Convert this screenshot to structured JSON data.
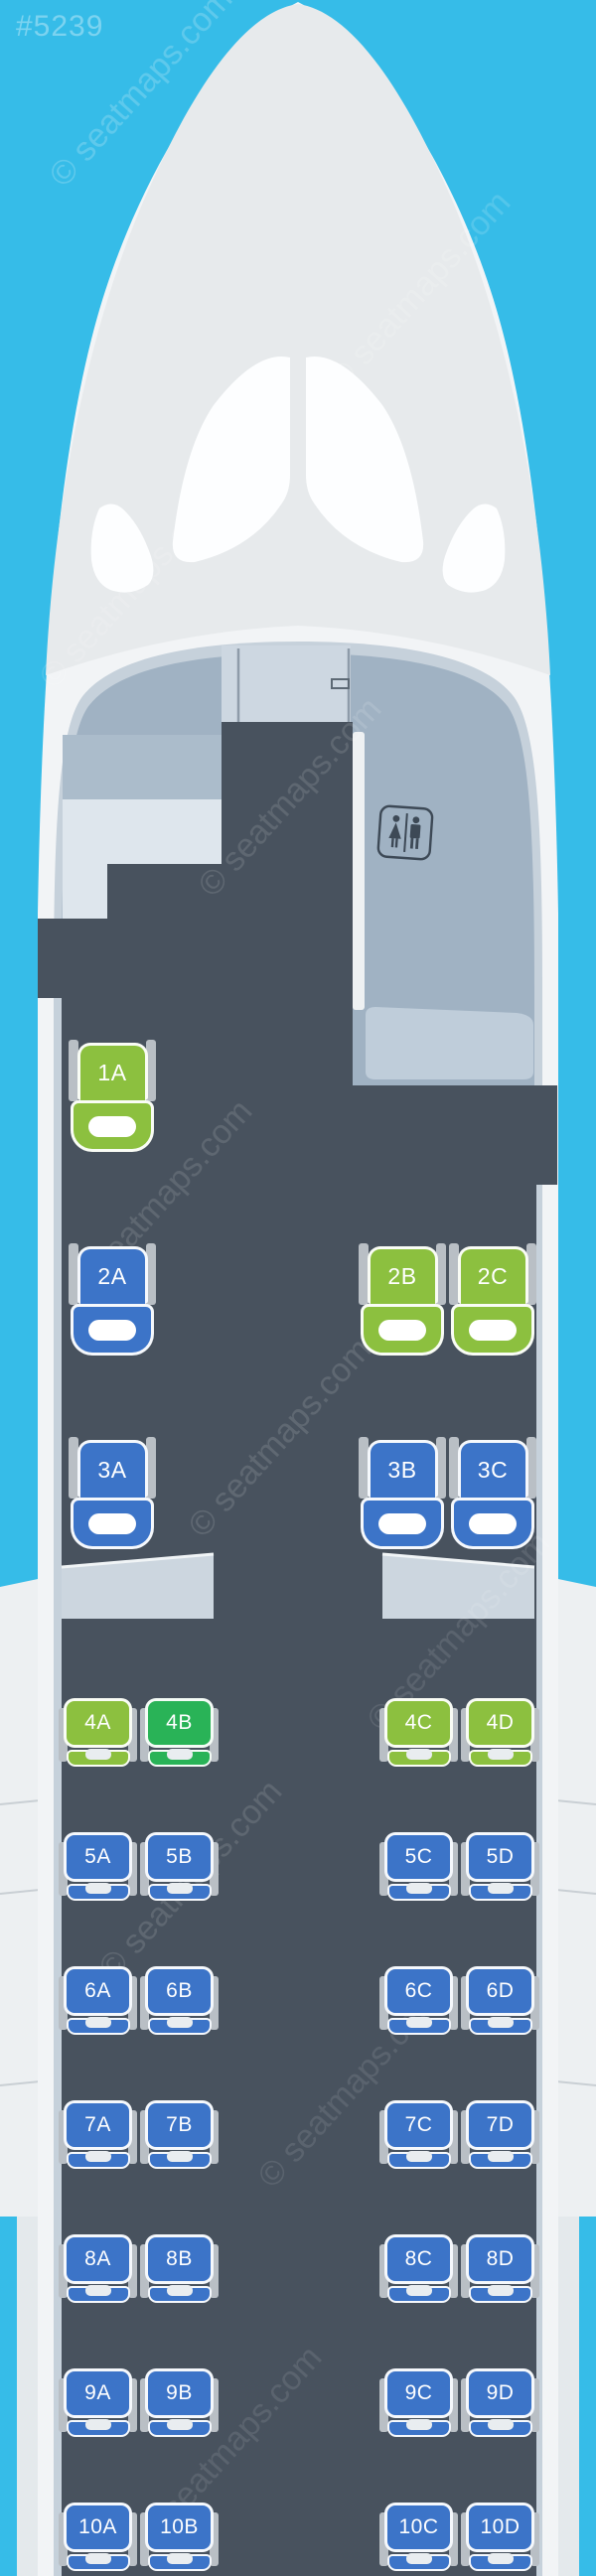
{
  "page": {
    "id_tag": "#5239",
    "watermark_text": "© seatmaps.com"
  },
  "colors": {
    "background_blue": "#36bce8",
    "fuselage_white": "#f2f4f6",
    "nose_gray": "#e7eaec",
    "windshield_white": "#fdfeff",
    "cabin_dark": "#48525e",
    "interior_bluegray": "#a0b2c3",
    "arch_rim": "#c6d1db",
    "cockpit_door": "#cdd7e1",
    "galley_top": "#abbccb",
    "galley_bottom": "#dee6ed",
    "closet_monument": "#bfcdda",
    "bulkhead_slab": "#ccd6df",
    "wing_gray": "#edf0f2",
    "nacelle_gray": "#e4e9ec",
    "seat_blue": "#3c74c8",
    "seat_green": "#8cc03f",
    "seat_emerald": "#29b357",
    "armrest_gray": "#b9bfc5",
    "lavatory_icon": "#3d4956"
  },
  "icons": {
    "lavatory": "lavatory-sign"
  },
  "seat_rows": [
    {
      "row": "1",
      "seats": [
        {
          "id": "1A",
          "color": "green"
        }
      ]
    },
    {
      "row": "2",
      "seats": [
        {
          "id": "2A",
          "color": "blue"
        },
        {
          "id": "2B",
          "color": "green"
        },
        {
          "id": "2C",
          "color": "green"
        }
      ]
    },
    {
      "row": "3",
      "seats": [
        {
          "id": "3A",
          "color": "blue"
        },
        {
          "id": "3B",
          "color": "blue"
        },
        {
          "id": "3C",
          "color": "blue"
        }
      ]
    },
    {
      "row": "4",
      "seats": [
        {
          "id": "4A",
          "color": "green"
        },
        {
          "id": "4B",
          "color": "emerald"
        },
        {
          "id": "4C",
          "color": "green"
        },
        {
          "id": "4D",
          "color": "green"
        }
      ]
    },
    {
      "row": "5",
      "seats": [
        {
          "id": "5A",
          "color": "blue"
        },
        {
          "id": "5B",
          "color": "blue"
        },
        {
          "id": "5C",
          "color": "blue"
        },
        {
          "id": "5D",
          "color": "blue"
        }
      ]
    },
    {
      "row": "6",
      "seats": [
        {
          "id": "6A",
          "color": "blue"
        },
        {
          "id": "6B",
          "color": "blue"
        },
        {
          "id": "6C",
          "color": "blue"
        },
        {
          "id": "6D",
          "color": "blue"
        }
      ]
    },
    {
      "row": "7",
      "seats": [
        {
          "id": "7A",
          "color": "blue"
        },
        {
          "id": "7B",
          "color": "blue"
        },
        {
          "id": "7C",
          "color": "blue"
        },
        {
          "id": "7D",
          "color": "blue"
        }
      ]
    },
    {
      "row": "8",
      "seats": [
        {
          "id": "8A",
          "color": "blue"
        },
        {
          "id": "8B",
          "color": "blue"
        },
        {
          "id": "8C",
          "color": "blue"
        },
        {
          "id": "8D",
          "color": "blue"
        }
      ]
    },
    {
      "row": "9",
      "seats": [
        {
          "id": "9A",
          "color": "blue"
        },
        {
          "id": "9B",
          "color": "blue"
        },
        {
          "id": "9C",
          "color": "blue"
        },
        {
          "id": "9D",
          "color": "blue"
        }
      ]
    },
    {
      "row": "10",
      "seats": [
        {
          "id": "10A",
          "color": "blue"
        },
        {
          "id": "10B",
          "color": "blue"
        },
        {
          "id": "10C",
          "color": "blue"
        },
        {
          "id": "10D",
          "color": "blue"
        }
      ]
    }
  ]
}
